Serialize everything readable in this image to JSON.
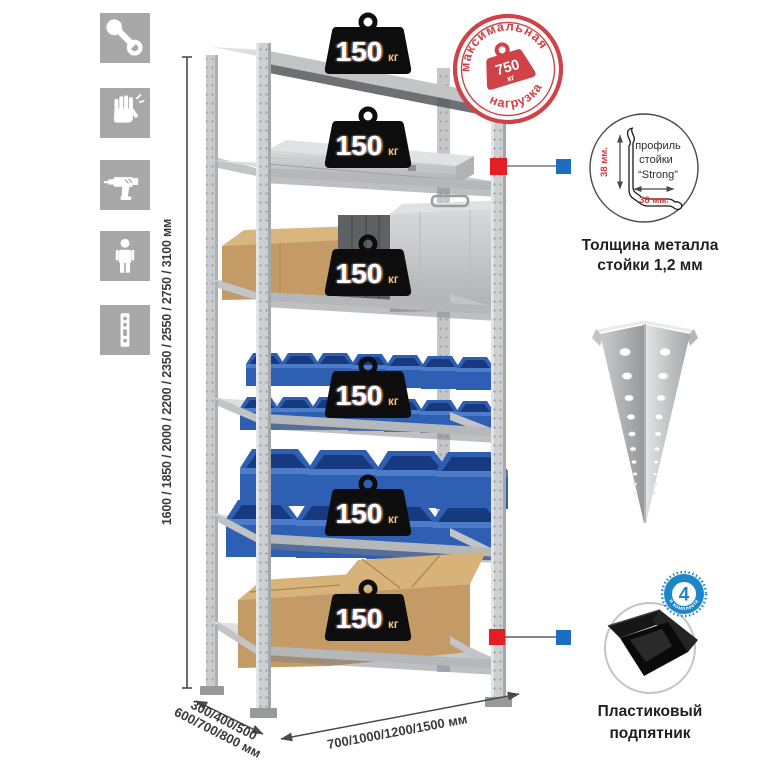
{
  "page": {
    "background": "#ffffff"
  },
  "colors": {
    "accent_red": "#d6393f",
    "accent_blue": "#1c6fc0",
    "metal_gray": "#cdd0d2",
    "bin_blue": "#2f63b5",
    "badge_black": "#0d0d0d"
  },
  "left_icons": [
    {
      "name": "wrench-icon"
    },
    {
      "name": "gloves-icon"
    },
    {
      "name": "drill-icon"
    },
    {
      "name": "person-icon"
    },
    {
      "name": "upright-icon"
    }
  ],
  "dimensions": {
    "height_label": "1600 / 1850 / 2000 / 2200 / 2350 / 2550 / 2750 / 3100 мм",
    "depth_line1": "300/400/500",
    "depth_line2": "600/700/800 мм",
    "width_label": "700/1000/1200/1500 мм"
  },
  "shelves": [
    {
      "load": "150",
      "unit": "кг"
    },
    {
      "load": "150",
      "unit": "кг"
    },
    {
      "load": "150",
      "unit": "кг"
    },
    {
      "load": "150",
      "unit": "кг"
    },
    {
      "load": "150",
      "unit": "кг"
    },
    {
      "load": "150",
      "unit": "кг"
    }
  ],
  "stamp": {
    "arc_top": "максимальная",
    "arc_bottom": "нагрузка",
    "value": "750",
    "unit": "кг"
  },
  "profile_detail": {
    "label_line1": "профиль",
    "label_line2": "стойки",
    "label_line3": "“Strong”",
    "dim_side": "38 мм.",
    "dim_bottom": "38 мм.",
    "caption_line1": "Толщина металла",
    "caption_line2": "стойки 1,2 мм"
  },
  "foot_detail": {
    "badge_count": "4",
    "badge_arc": "в комплекте",
    "caption_line1": "Пластиковый",
    "caption_line2": "подпятник"
  }
}
